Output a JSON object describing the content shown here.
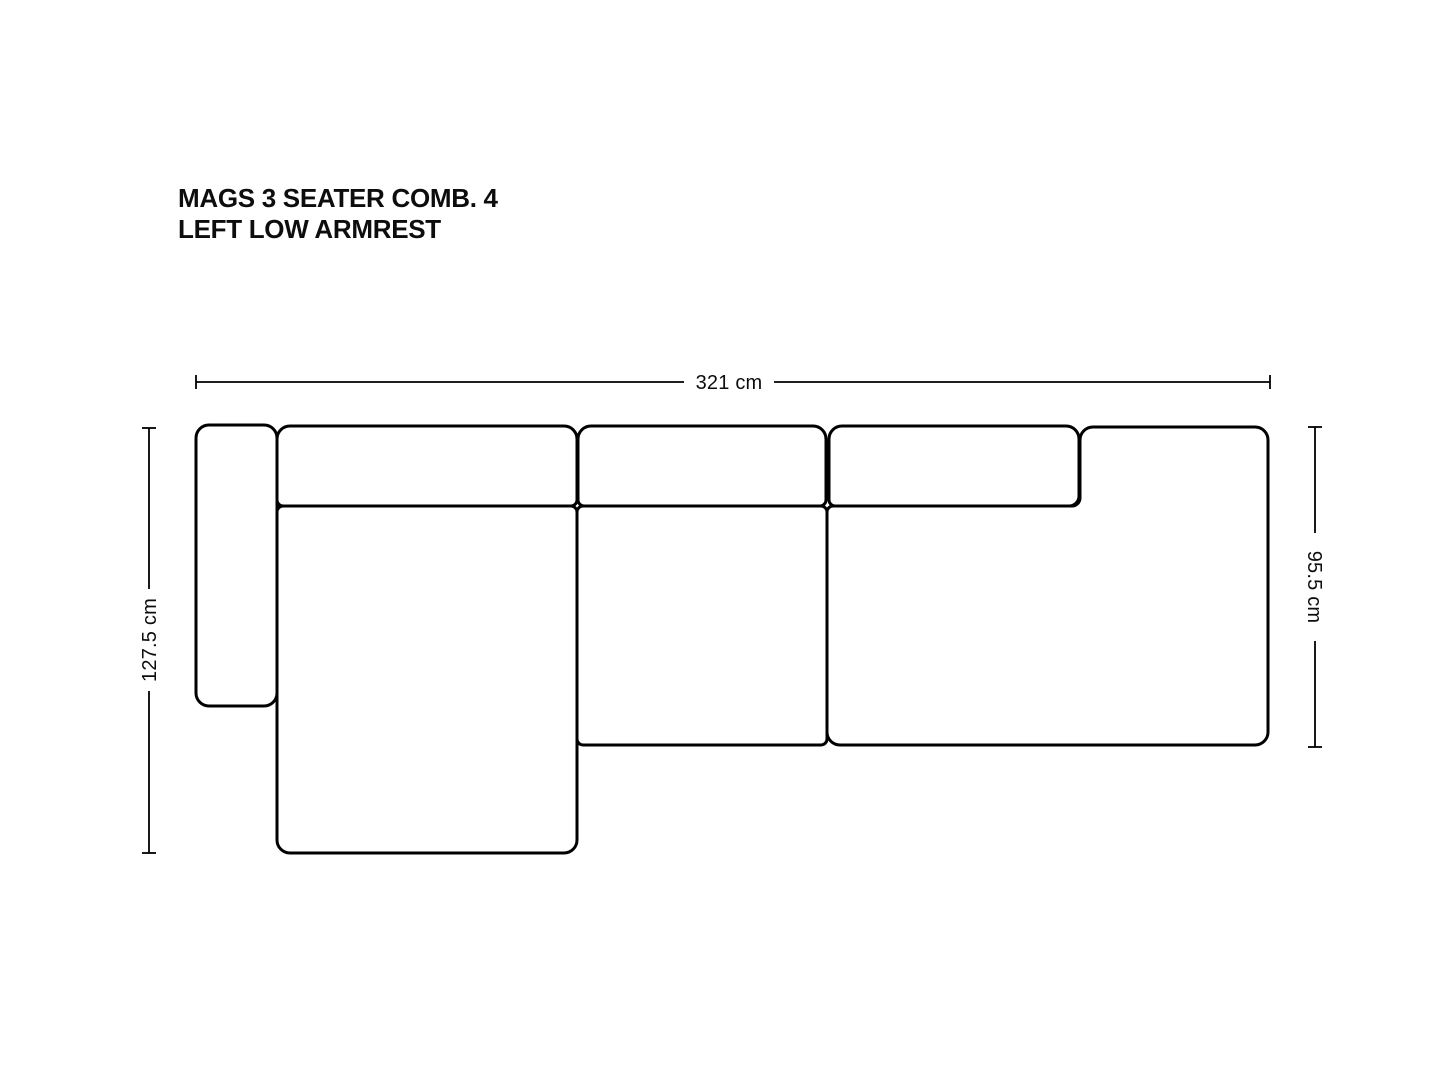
{
  "title": {
    "line1": "MAGS 3 SEATER COMB. 4",
    "line2": "LEFT LOW ARMREST"
  },
  "dimensions": {
    "overall_width": "321 cm",
    "overall_depth": "127.5 cm",
    "seat_depth": "95.5 cm"
  },
  "colors": {
    "line": "#000000",
    "text": "#0d0d0d",
    "background": "#ffffff"
  }
}
